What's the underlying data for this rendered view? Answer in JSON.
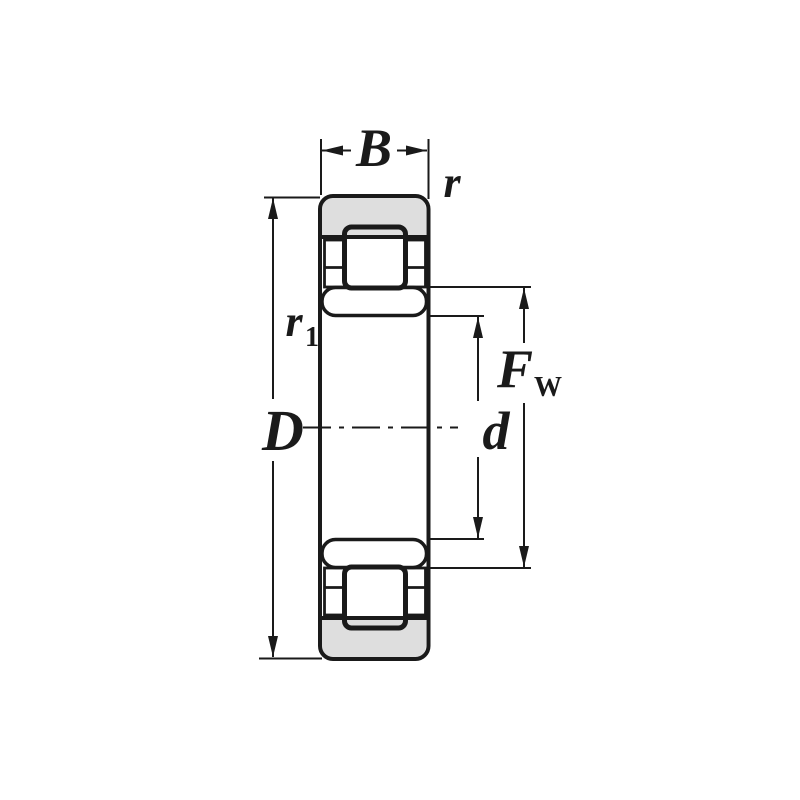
{
  "diagram": {
    "type": "cylindrical-roller-bearing-cross-section",
    "labels": {
      "width": "B",
      "outer_chamfer": "r",
      "inner_chamfer_base": "r",
      "inner_chamfer_sub": "1",
      "outer_diameter": "D",
      "bore_diameter": "d",
      "roller_pitch_base": "F",
      "roller_pitch_sub": "W"
    },
    "colors": {
      "line": "#1a1a1a",
      "ring_fill": "#dedede",
      "background": "#ffffff"
    }
  }
}
